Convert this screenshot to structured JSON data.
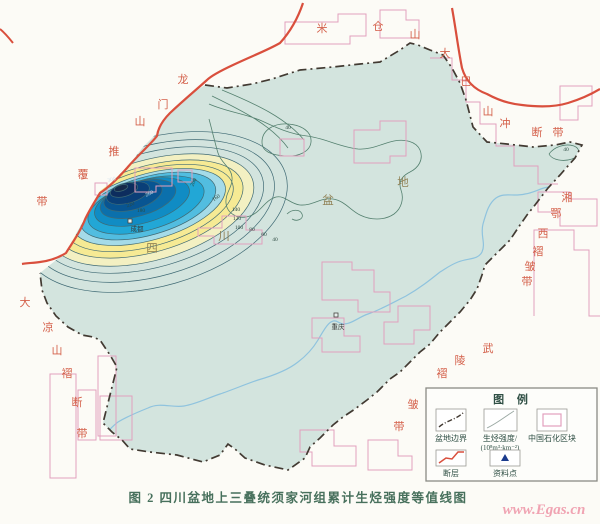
{
  "figure": {
    "caption": "图 2  四川盆地上三叠统须家河组累计生烃强度等值线图",
    "watermark": "www.Egas.cn"
  },
  "legend": {
    "title": "图 例",
    "basin_boundary": "盆地边界",
    "intensity_line1": "生烃强度/",
    "intensity_line2": "(10⁸m³·km⁻²)",
    "sinopec_block": "中国石化区块",
    "fault": "断层",
    "data_point": "资料点"
  },
  "map": {
    "basin_name_text": "四川盆地",
    "basin_name": [
      {
        "ch": "四",
        "x": 152,
        "y": 252
      },
      {
        "ch": "川",
        "x": 224,
        "y": 240
      },
      {
        "ch": "盆",
        "x": 328,
        "y": 204
      },
      {
        "ch": "地",
        "x": 403,
        "y": 186
      }
    ],
    "region_labels": [
      {
        "name": "longmenshan-thrust-belt",
        "text": "龙门山推覆带",
        "chars": [
          {
            "ch": "龙",
            "x": 183,
            "y": 83
          },
          {
            "ch": "门",
            "x": 163,
            "y": 108
          },
          {
            "ch": "山",
            "x": 140,
            "y": 125
          },
          {
            "ch": "推",
            "x": 114,
            "y": 155
          },
          {
            "ch": "覆",
            "x": 83,
            "y": 178
          },
          {
            "ch": "带",
            "x": 42,
            "y": 205
          }
        ]
      },
      {
        "name": "micangshan",
        "text": "米仓山",
        "chars": [
          {
            "ch": "米",
            "x": 322,
            "y": 32
          },
          {
            "ch": "仓",
            "x": 378,
            "y": 30
          },
          {
            "ch": "山",
            "x": 415,
            "y": 38
          }
        ]
      },
      {
        "name": "dabashan-thrust-belt",
        "text": "大巴山冲断带",
        "chars": [
          {
            "ch": "大",
            "x": 445,
            "y": 57
          },
          {
            "ch": "巴",
            "x": 466,
            "y": 85
          },
          {
            "ch": "山",
            "x": 488,
            "y": 115
          },
          {
            "ch": "冲",
            "x": 505,
            "y": 127
          },
          {
            "ch": "断",
            "x": 537,
            "y": 136
          },
          {
            "ch": "带",
            "x": 558,
            "y": 136
          }
        ]
      },
      {
        "name": "xiangexi-fold-belt",
        "text": "湘鄂西褶皱带",
        "chars": [
          {
            "ch": "湘",
            "x": 567,
            "y": 201
          },
          {
            "ch": "鄂",
            "x": 556,
            "y": 217
          },
          {
            "ch": "西",
            "x": 543,
            "y": 237
          },
          {
            "ch": "褶",
            "x": 538,
            "y": 255
          },
          {
            "ch": "皱",
            "x": 530,
            "y": 270
          },
          {
            "ch": "带",
            "x": 527,
            "y": 285
          }
        ]
      },
      {
        "name": "wuling-fold-belt",
        "text": "武陵褶皱带",
        "chars": [
          {
            "ch": "武",
            "x": 488,
            "y": 352
          },
          {
            "ch": "陵",
            "x": 460,
            "y": 364
          },
          {
            "ch": "褶",
            "x": 442,
            "y": 377
          },
          {
            "ch": "皱",
            "x": 413,
            "y": 408
          },
          {
            "ch": "带",
            "x": 399,
            "y": 430
          }
        ]
      },
      {
        "name": "daliangshan-fold-fault-belt",
        "text": "大凉山褶断带",
        "chars": [
          {
            "ch": "大",
            "x": 25,
            "y": 306
          },
          {
            "ch": "凉",
            "x": 48,
            "y": 331
          },
          {
            "ch": "山",
            "x": 57,
            "y": 354
          },
          {
            "ch": "褶",
            "x": 67,
            "y": 377
          },
          {
            "ch": "断",
            "x": 77,
            "y": 406
          },
          {
            "ch": "带",
            "x": 82,
            "y": 437
          }
        ]
      }
    ],
    "cities": [
      {
        "label": "成都",
        "x": 137,
        "y": 231,
        "mx": 128,
        "my": 219
      },
      {
        "label": "重庆",
        "x": 338,
        "y": 329,
        "mx": 334,
        "my": 313
      }
    ],
    "contour_levels": [
      40,
      60,
      80,
      100,
      120,
      140,
      160,
      180,
      200,
      220,
      240,
      260,
      280,
      300
    ],
    "contour_labels": [
      {
        "v": "40",
        "x": 288,
        "y": 129,
        "r": 0
      },
      {
        "v": "40",
        "x": 566,
        "y": 151,
        "r": 0
      },
      {
        "v": "40",
        "x": 275,
        "y": 241,
        "r": 0
      },
      {
        "v": "60",
        "x": 264,
        "y": 236,
        "r": 0
      },
      {
        "v": "80",
        "x": 252,
        "y": 231,
        "r": 0
      },
      {
        "v": "100",
        "x": 239,
        "y": 229,
        "r": 0
      },
      {
        "v": "120",
        "x": 237,
        "y": 220,
        "r": 0
      },
      {
        "v": "140",
        "x": 236,
        "y": 211,
        "r": 0
      },
      {
        "v": "160",
        "x": 217,
        "y": 199,
        "r": -35
      },
      {
        "v": "180",
        "x": 141,
        "y": 212,
        "r": 0
      },
      {
        "v": "200",
        "x": 195,
        "y": 183,
        "r": -65
      },
      {
        "v": "220",
        "x": 131,
        "y": 206,
        "r": -20
      },
      {
        "v": "260",
        "x": 150,
        "y": 195,
        "r": -25,
        "light": true
      },
      {
        "v": "300",
        "x": 112,
        "y": 181,
        "r": -15,
        "light": true
      }
    ]
  },
  "colors": {
    "fault_red": "#d94f3d",
    "block_pink": "#e2a0bd",
    "label_red": "#d4604a",
    "basin_fill": "#d3e4de",
    "contour": "#54806f",
    "river": "#8fc3de",
    "caption_green": "#47705c",
    "watermark_pink": "#f0a3b2",
    "boundary_dark": "#423a32",
    "intensity_high": "#0d2d5e",
    "intensity_mid": "#22a7d6",
    "intensity_low_yellow": "#f6ea94"
  }
}
